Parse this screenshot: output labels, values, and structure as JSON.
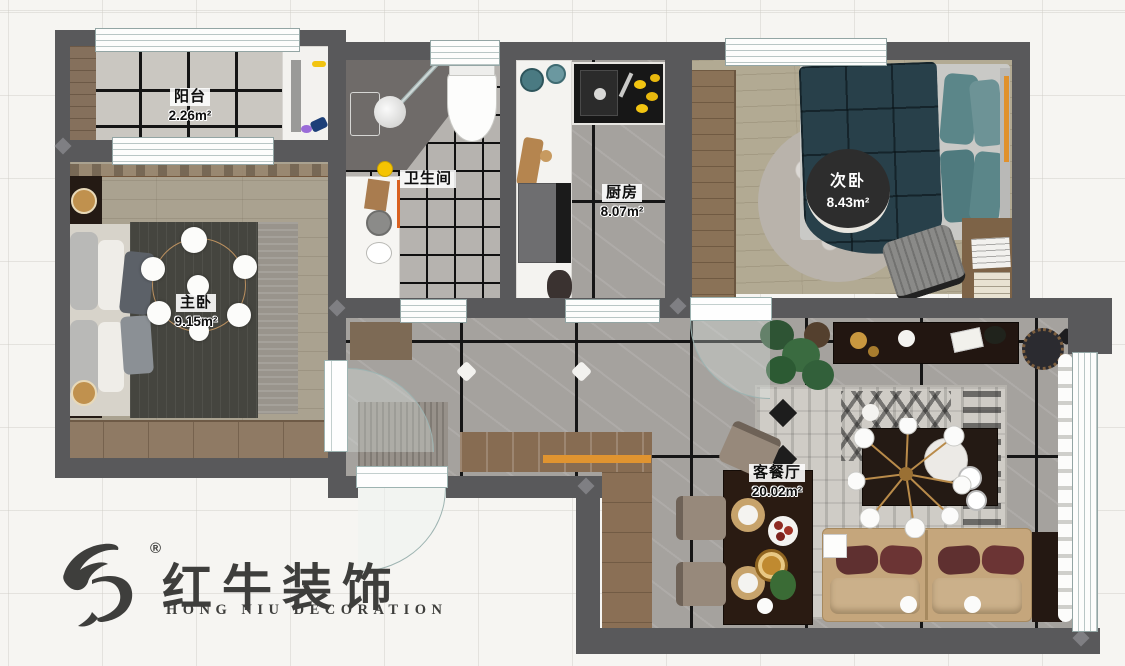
{
  "rooms": {
    "balcony": {
      "name": "阳台",
      "area": "2.26m²"
    },
    "master_bedroom": {
      "name": "主卧",
      "area": "9.15m²"
    },
    "bathroom": {
      "name": "卫生间"
    },
    "kitchen": {
      "name": "厨房",
      "area": "8.07m²"
    },
    "second_bedroom": {
      "name": "次卧",
      "area": "8.43m²"
    },
    "living_dining": {
      "name": "客餐厅",
      "area": "20.02m²"
    }
  },
  "logo": {
    "brand": "红牛装饰",
    "subtitle": "HONG NIU DECORATION",
    "registered": "®"
  },
  "colors": {
    "wall": "#59595b",
    "accent_orange": "#e0912c",
    "bed_teal": "#28404a",
    "pillow_teal": "#5b8689",
    "sofa_tan": "#c5a67c",
    "sofa_pillow_red": "#5f3030"
  }
}
